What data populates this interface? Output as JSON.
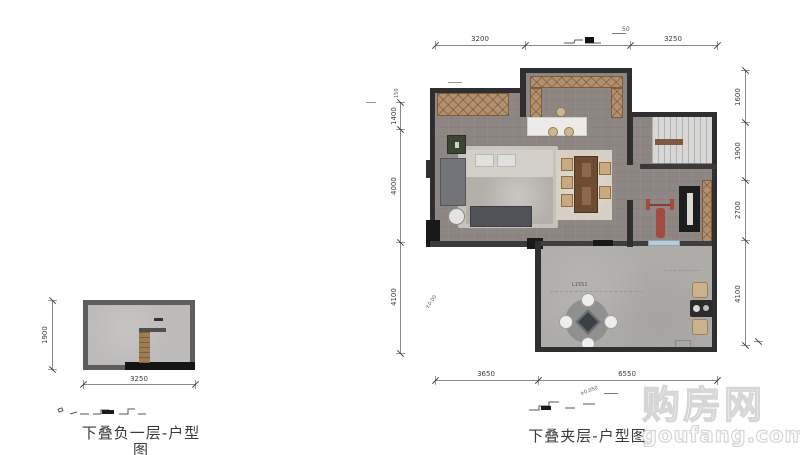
{
  "watermark": {
    "title": "购房网",
    "domain": "goufang.com"
  },
  "left_plan": {
    "title": "下叠负一层-户型图",
    "dims": {
      "height": "1900",
      "width": "3250"
    }
  },
  "right_plan": {
    "title": "下叠夹层-户型图",
    "dims": {
      "top_left": "3200",
      "top_right": "3250",
      "left_top": "1400",
      "left_middle": "4000",
      "left_bottom": "4100",
      "right_top": "1600",
      "right_upper": "1900",
      "right_middle": "2700",
      "right_bottom": "4100",
      "bottom_left": "3650",
      "bottom_right": "6550"
    },
    "annotations": {
      "top_level": "50",
      "left_level": "150",
      "section_level": "±0.050",
      "terrace_note": "L1551",
      "terrace_level": "±0.00"
    }
  },
  "palette": {
    "wall_dark": "#2f2f2f",
    "wall_gray": "#5d5d5d",
    "floor_interior": "#8d8682",
    "floor_terrace": "#aeaca9",
    "closet_wood": "#b28f6d",
    "window_blue": "#b9cdd8",
    "gym_red": "#a34a41",
    "dim_line": "#8a8a8a",
    "watermark_gray": "#d6d6d6"
  }
}
